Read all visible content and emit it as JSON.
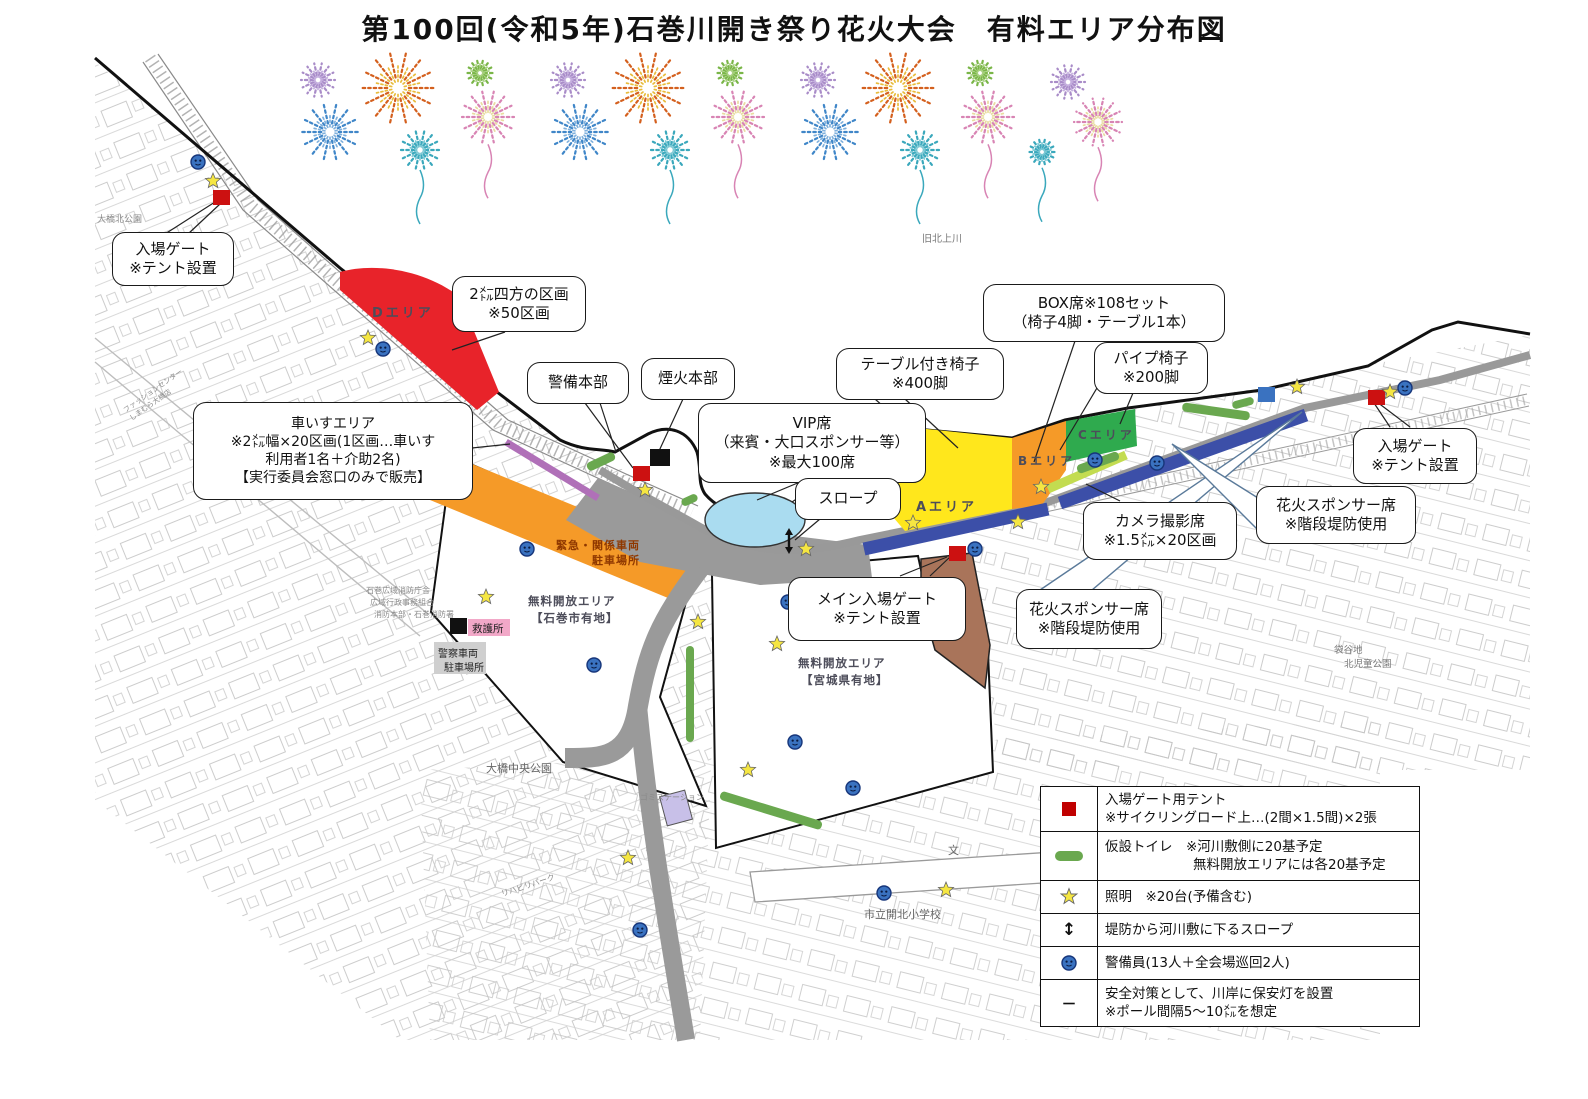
{
  "title": "第100回(令和5年)石巻川開き祭り花火大会　有料エリア分布図",
  "colors": {
    "area_d": "#e8232a",
    "area_a": "#ffe71c",
    "area_b": "#f59a28",
    "area_c": "#2faa4e",
    "emergency_band": "#f59a28",
    "vip_pond": "#aadcf0",
    "sponsor_strip": "#3c4fa8",
    "camera_strip": "#c3dc50",
    "wheelchair_strip": "#b070b8",
    "toilet": "#6aa84f",
    "gate_red": "#cc1111",
    "pyro_black": "#111111",
    "guard_blue": "#3a72c0",
    "star_yellow": "#f5e642",
    "road_gray": "#9a9a9a",
    "brown_house": "#a9745a",
    "rescue_pink": "#f2a8c8",
    "gomi_lavender": "#c8c0e8"
  },
  "callouts": {
    "gate_left": [
      "入場ゲート",
      "※テント設置"
    ],
    "d_block": [
      "2㍍四方の区画",
      "※50区画"
    ],
    "security_hq": [
      "警備本部"
    ],
    "pyro_hq": [
      "煙火本部"
    ],
    "box_seats": [
      "BOX席※108セット",
      "（椅子4脚・テーブル1本）"
    ],
    "table_chairs": [
      "テーブル付き椅子",
      "※400脚"
    ],
    "pipe_chairs": [
      "パイプ椅子",
      "※200脚"
    ],
    "vip": [
      "VIP席",
      "（来賓・大口スポンサー等）",
      "※最大100席"
    ],
    "slope": [
      "スロープ"
    ],
    "wheelchair": [
      "車いすエリア",
      "※2㍍幅×20区画(1区画…車いす",
      "利用者1名＋介助2名)",
      "【実行委員会窓口のみで販売】"
    ],
    "camera": [
      "カメラ撮影席",
      "※1.5㍍×20区画"
    ],
    "sponsor_right": [
      "花火スポンサー席",
      "※階段堤防使用"
    ],
    "gate_right": [
      "入場ゲート",
      "※テント設置"
    ],
    "main_gate": [
      "メイン入場ゲート",
      "※テント設置"
    ],
    "sponsor_center": [
      "花火スポンサー席",
      "※階段堤防使用"
    ]
  },
  "labels": {
    "river": "旧北上川",
    "park_nw": "大橋北公園",
    "fashion1": "ファッションセンター",
    "fashion2": "しまむら大橋店",
    "fire1": "石巻広域消防庁舎",
    "fire2": "広域行政事務組合",
    "fire3": "消防本部・石巻消防署",
    "central_park": "大橋中央公園",
    "rehab": "リハビリパーク",
    "gomi": "ゴミステーション",
    "school": "市立開北小学校",
    "school_mark": "文",
    "kita1": "袋谷地",
    "kita2": "北児童公園",
    "minka": "民家",
    "kyugo": "救護所",
    "police1": "警察車両",
    "police2": "駐車場所",
    "emerg1": "緊急・関係車両",
    "emerg2": "駐車場所",
    "free_l1": "無料開放エリア",
    "free_l2": "【石巻市有地】",
    "free_r1": "無料開放エリア",
    "free_r2": "【宮城県有地】",
    "area_a": "Aエリア",
    "area_b": "Bエリア",
    "area_c": "Cエリア",
    "area_d": "Dエリア"
  },
  "legend": {
    "rows": [
      {
        "l1": "入場ゲート用テント",
        "l2": "※サイクリングロード上…(2間×1.5間)×2張"
      },
      {
        "l1": "仮設トイレ　※河川敷側に20基予定",
        "l2": "無料開放エリアには各20基予定"
      },
      {
        "l1": "照明　※20台(予備含む)",
        "l2": ""
      },
      {
        "l1": "堤防から河川敷に下るスロープ",
        "l2": ""
      },
      {
        "l1": "警備員(13人＋全会場巡回2人)",
        "l2": ""
      },
      {
        "l1": "安全対策として、川岸に保安灯を設置",
        "l2": "※ポール間隔5～10㍍を想定"
      }
    ]
  },
  "decor": {
    "fireworks": [
      [
        318,
        80,
        17,
        "#a98cc8",
        "#c4aede",
        0
      ],
      [
        398,
        88,
        36,
        "#d4601e",
        "#e8bc3c",
        0
      ],
      [
        480,
        73,
        15,
        "#7ab648",
        "#a8d080",
        0
      ],
      [
        330,
        132,
        29,
        "#3f86c8",
        "#7fb0dc",
        0
      ],
      [
        420,
        150,
        19,
        "#3aa8bc",
        "#7cc8d4",
        1
      ],
      [
        488,
        117,
        26,
        "#d884b4",
        "#e8dca0",
        1
      ],
      [
        568,
        80,
        17,
        "#a98cc8",
        "#c4aede",
        0
      ],
      [
        648,
        88,
        36,
        "#d4601e",
        "#e8bc3c",
        0
      ],
      [
        730,
        73,
        15,
        "#7ab648",
        "#a8d080",
        0
      ],
      [
        580,
        132,
        29,
        "#3f86c8",
        "#7fb0dc",
        0
      ],
      [
        670,
        150,
        19,
        "#3aa8bc",
        "#7cc8d4",
        1
      ],
      [
        738,
        117,
        26,
        "#d884b4",
        "#e8dca0",
        1
      ],
      [
        818,
        80,
        17,
        "#a98cc8",
        "#c4aede",
        0
      ],
      [
        898,
        88,
        36,
        "#d4601e",
        "#e8bc3c",
        0
      ],
      [
        980,
        73,
        15,
        "#7ab648",
        "#a8d080",
        0
      ],
      [
        830,
        132,
        29,
        "#3f86c8",
        "#7fb0dc",
        0
      ],
      [
        920,
        150,
        19,
        "#3aa8bc",
        "#7cc8d4",
        1
      ],
      [
        988,
        117,
        26,
        "#d884b4",
        "#e8dca0",
        1
      ],
      [
        1068,
        82,
        17,
        "#a98cc8",
        "#c4aede",
        0
      ],
      [
        1098,
        122,
        24,
        "#d884b4",
        "#e8dca0",
        1
      ],
      [
        1042,
        152,
        15,
        "#3aa8bc",
        "#7cc8d4",
        1
      ]
    ],
    "stars": [
      [
        213,
        181
      ],
      [
        368,
        338
      ],
      [
        645,
        490
      ],
      [
        486,
        597
      ],
      [
        698,
        622
      ],
      [
        913,
        523
      ],
      [
        806,
        549
      ],
      [
        777,
        644
      ],
      [
        628,
        858
      ],
      [
        748,
        770
      ],
      [
        946,
        890
      ],
      [
        1297,
        387
      ],
      [
        1390,
        392
      ],
      [
        1041,
        487
      ],
      [
        1018,
        522
      ]
    ],
    "guards": [
      [
        198,
        162
      ],
      [
        383,
        349
      ],
      [
        527,
        549
      ],
      [
        594,
        665
      ],
      [
        788,
        602
      ],
      [
        795,
        742
      ],
      [
        853,
        788
      ],
      [
        884,
        893
      ],
      [
        975,
        549
      ],
      [
        1095,
        460
      ],
      [
        1157,
        463
      ],
      [
        1405,
        388
      ],
      [
        640,
        930
      ]
    ],
    "gate_tents": [
      [
        213,
        190
      ],
      [
        633,
        466
      ],
      [
        949,
        546
      ],
      [
        1368,
        390
      ]
    ],
    "black_square": [
      650,
      449
    ],
    "blue_square": [
      1258,
      387
    ],
    "slope_arrows": [
      [
        789,
        541
      ]
    ],
    "toilets": [
      [
        586,
        457,
        30,
        9,
        -25
      ],
      [
        681,
        496,
        17,
        8,
        -25
      ],
      [
        1182,
        407,
        68,
        9,
        8
      ],
      [
        1076,
        458,
        44,
        9,
        -20
      ],
      [
        686,
        646,
        8,
        96,
        0
      ],
      [
        718,
        806,
        106,
        9,
        17
      ],
      [
        1232,
        399,
        22,
        8,
        -15
      ]
    ]
  }
}
